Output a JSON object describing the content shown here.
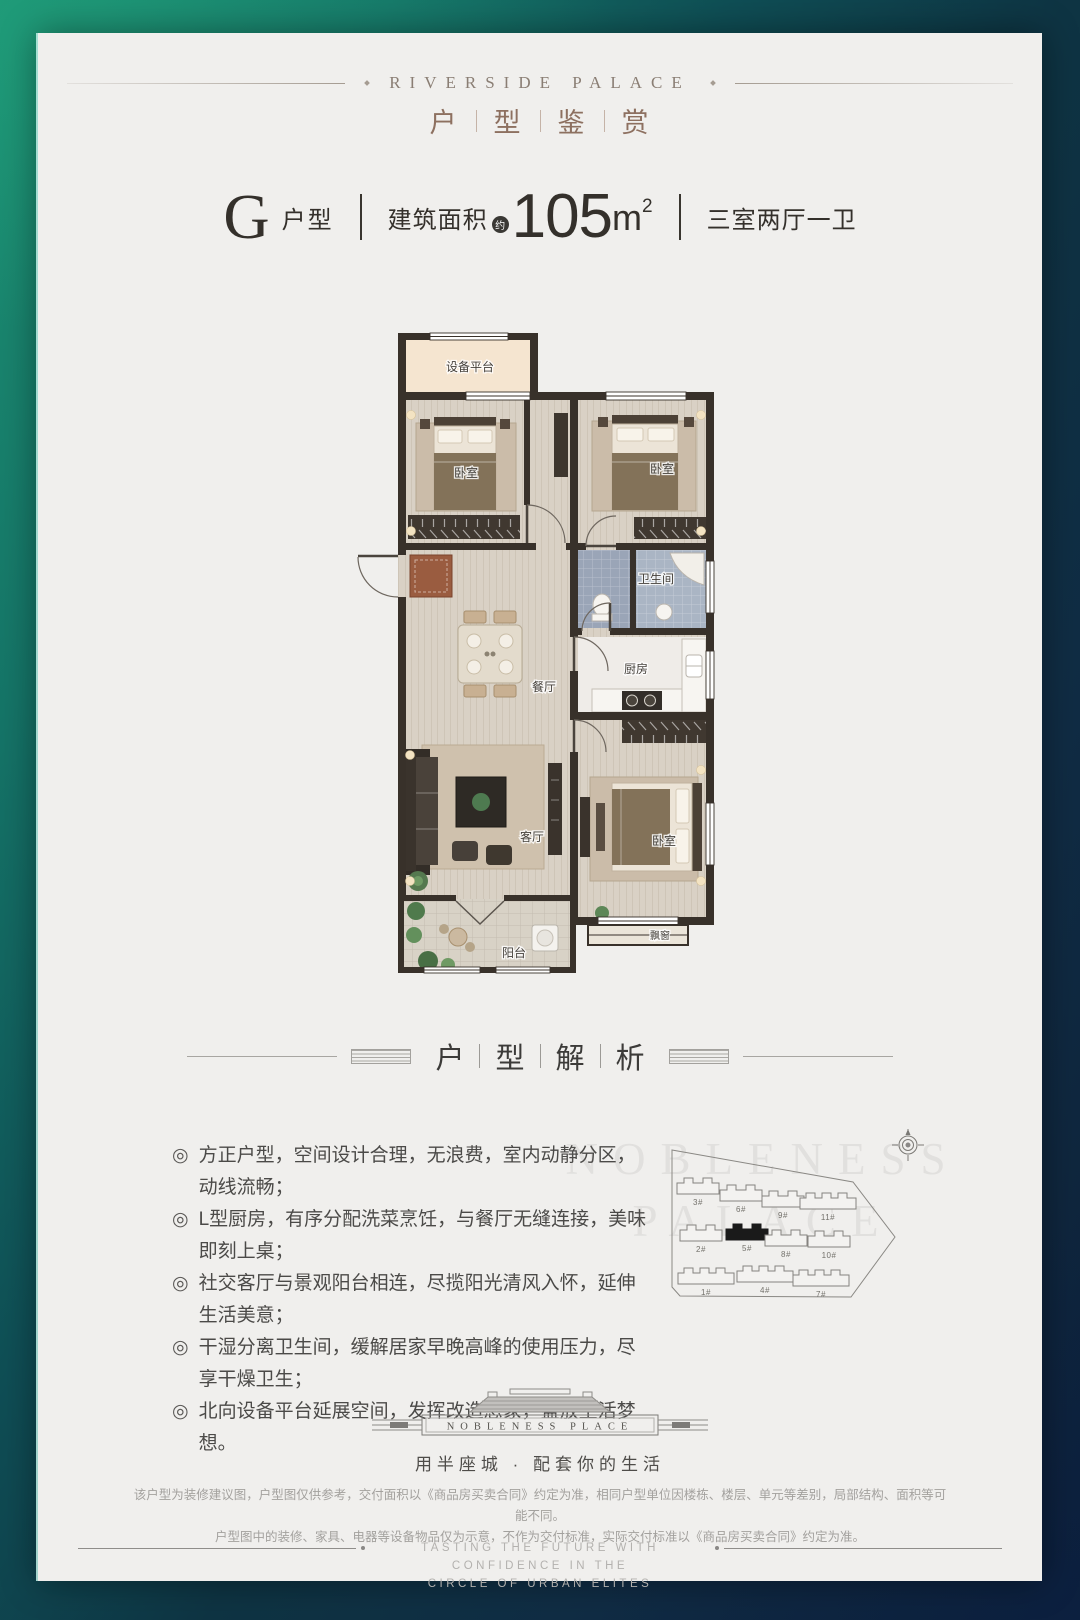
{
  "colors": {
    "bg_teal": "#1d9273",
    "bg_navy": "#0e2138",
    "card": "#f0efed",
    "accent_brown": "#8d7060",
    "wall": "#38312a",
    "highlight": "#1a1a1a"
  },
  "header": {
    "en_title": "RIVERSIDE PALACE",
    "cn_chars": [
      "户",
      "型",
      "鉴",
      "赏"
    ]
  },
  "unit": {
    "letter": "G",
    "type_label": "户型",
    "area_label": "建筑面积",
    "approx": "约",
    "area_value": "105",
    "area_unit": "m",
    "area_sup": "2",
    "rooms_label": "三室两厅一卫"
  },
  "floorplan": {
    "rooms": {
      "platform": "设备平台",
      "bedroom_a": "卧室",
      "bedroom_b": "卧室",
      "bathroom": "卫生间",
      "kitchen": "厨房",
      "dining": "餐厅",
      "living": "客厅",
      "master": "卧室",
      "balcony": "阳台",
      "bay": "飘窗"
    }
  },
  "analysis": {
    "chars": [
      "户",
      "型",
      "解",
      "析"
    ],
    "bullet": "◎",
    "items": [
      "方正户型，空间设计合理，无浪费，室内动静分区，动线流畅；",
      "L型厨房，有序分配洗菜烹饪，与餐厅无缝连接，美味即刻上桌；",
      "社交客厅与景观阳台相连，尽揽阳光清风入怀，延伸生活美意；",
      "干湿分离卫生间，缓解居家早晚高峰的使用压力，尽享干燥卫生；",
      "北向设备平台延展空间，发挥改造想象，盛放生活梦想。"
    ]
  },
  "siteplan": {
    "buildings": [
      "3#",
      "6#",
      "9#",
      "11#",
      "2#",
      "5#",
      "8#",
      "10#",
      "1#",
      "4#",
      "7#"
    ],
    "highlighted": "5#",
    "watermark1": "NOBLENESS",
    "watermark2": "PALACE"
  },
  "logo": {
    "name": "NOBLENESS PLACE",
    "tagline": "用半座城 · 配套你的生活"
  },
  "disclaimer": {
    "line1": "该户型为装修建议图，户型图仅供参考，交付面积以《商品房买卖合同》约定为准，相同户型单位因楼栋、楼层、单元等差别，局部结构、面积等可能不同。",
    "line2": "户型图中的装修、家具、电器等设备物品仅为示意，不作为交付标准，实际交付标准以《商品房买卖合同》约定为准。"
  },
  "footer": {
    "line1": "TASTING THE FUTURE WITH CONFIDENCE IN THE",
    "line2": "CIRCLE OF URBAN ELITES"
  }
}
